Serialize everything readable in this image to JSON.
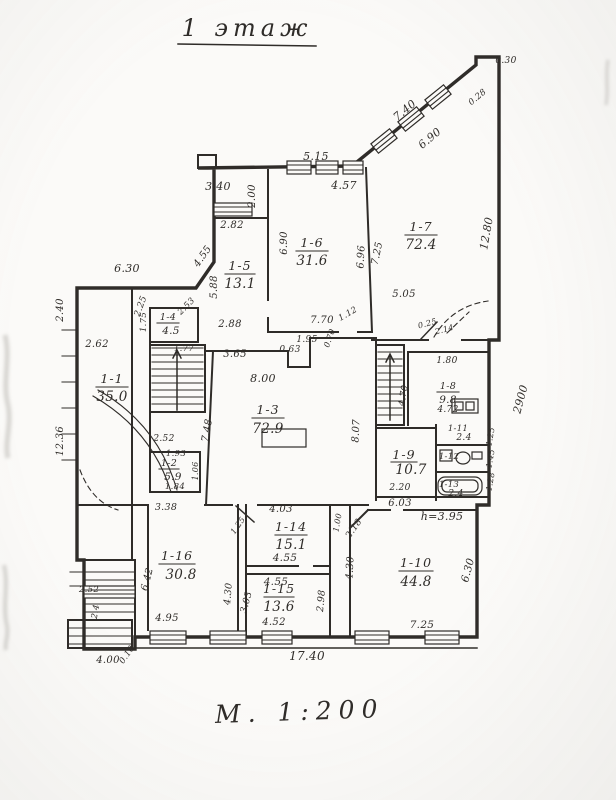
{
  "title": "1 этаж",
  "scale_note": "М. 1:200",
  "colors": {
    "ink": "#2f2c29",
    "paper": "#fbfaf8"
  },
  "rooms": {
    "r1": {
      "num": "1-1",
      "area": "35.0"
    },
    "r2": {
      "num": "1-2",
      "area": "5.9"
    },
    "r3": {
      "num": "1-3",
      "area": "72.9"
    },
    "r4": {
      "num": "1-4",
      "area": "4.5"
    },
    "r5": {
      "num": "1-5",
      "area": "13.1"
    },
    "r6": {
      "num": "1-6",
      "area": "31.6"
    },
    "r7": {
      "num": "1-7",
      "area": "72.4"
    },
    "r8": {
      "num": "1-8",
      "area": "9.8"
    },
    "r9": {
      "num": "1-9",
      "area": "10.7"
    },
    "r10": {
      "num": "1-10",
      "area": "44.8"
    },
    "r11": {
      "num": "1-11",
      "area": "2.4"
    },
    "r12": {
      "num": "1-12"
    },
    "r13": {
      "num": "1-13",
      "area": "2.4"
    },
    "r14": {
      "num": "1-14",
      "area": "15.1"
    },
    "r15": {
      "num": "1-15",
      "area": "13.6"
    },
    "r16": {
      "num": "1-16",
      "area": "30.8"
    }
  },
  "dims": {
    "d030": "0.30",
    "d740": "7.40",
    "d690d": "6.90",
    "d028": "0.28",
    "d1280": "12.80",
    "d2900": "2900",
    "d515": "5.15",
    "d457": "4.57",
    "d340": "3.40",
    "d200": "2.00",
    "d455d": "4.55",
    "d282": "2.82",
    "d588": "5.88",
    "d288": "2.88",
    "d690v": "6.90",
    "d696": "6.96",
    "d725v": "7.25",
    "d505": "5.05",
    "d770": "7.70",
    "d112": "1.12",
    "d630t": "6.30",
    "d225": "2.25",
    "d240": "2.40",
    "d262": "2.62",
    "d1236": "12.36",
    "d175": "1.75",
    "d253": "2.53",
    "d177": "1.77",
    "d365": "3.65",
    "d063": "0.63",
    "d195": "1.95",
    "d070": "0.70",
    "d800": "8.00",
    "d748": "7.48",
    "d807": "8.07",
    "d025": "0.25",
    "d214": "2.14",
    "d180": "1.80",
    "d470": "4.70",
    "d472": "4.72",
    "d220": "2.20",
    "d252a": "2.52",
    "d193": "1.93",
    "d184": "1.84",
    "d106": "1.06",
    "d338": "3.38",
    "d252b": "2.52",
    "d24c": "2.4",
    "d495": "4.95",
    "d642": "6.42",
    "d430a": "4.30",
    "d403": "4.03",
    "d455a": "4.55",
    "d455b": "4.55",
    "d303": "3.03",
    "d298": "2.98",
    "d452": "4.52",
    "d218": "2.18",
    "d100": "1.00",
    "d125": "1.25",
    "d603": "6.03",
    "h395": "h=3.95",
    "d630r": "6.30",
    "d725b": "7.25",
    "d430b": "4.30",
    "d1740": "17.40",
    "d400": "4.00",
    "d010": "0.10",
    "dw1": "1.25",
    "dw2": "1.45",
    "dw3": "1.28"
  }
}
